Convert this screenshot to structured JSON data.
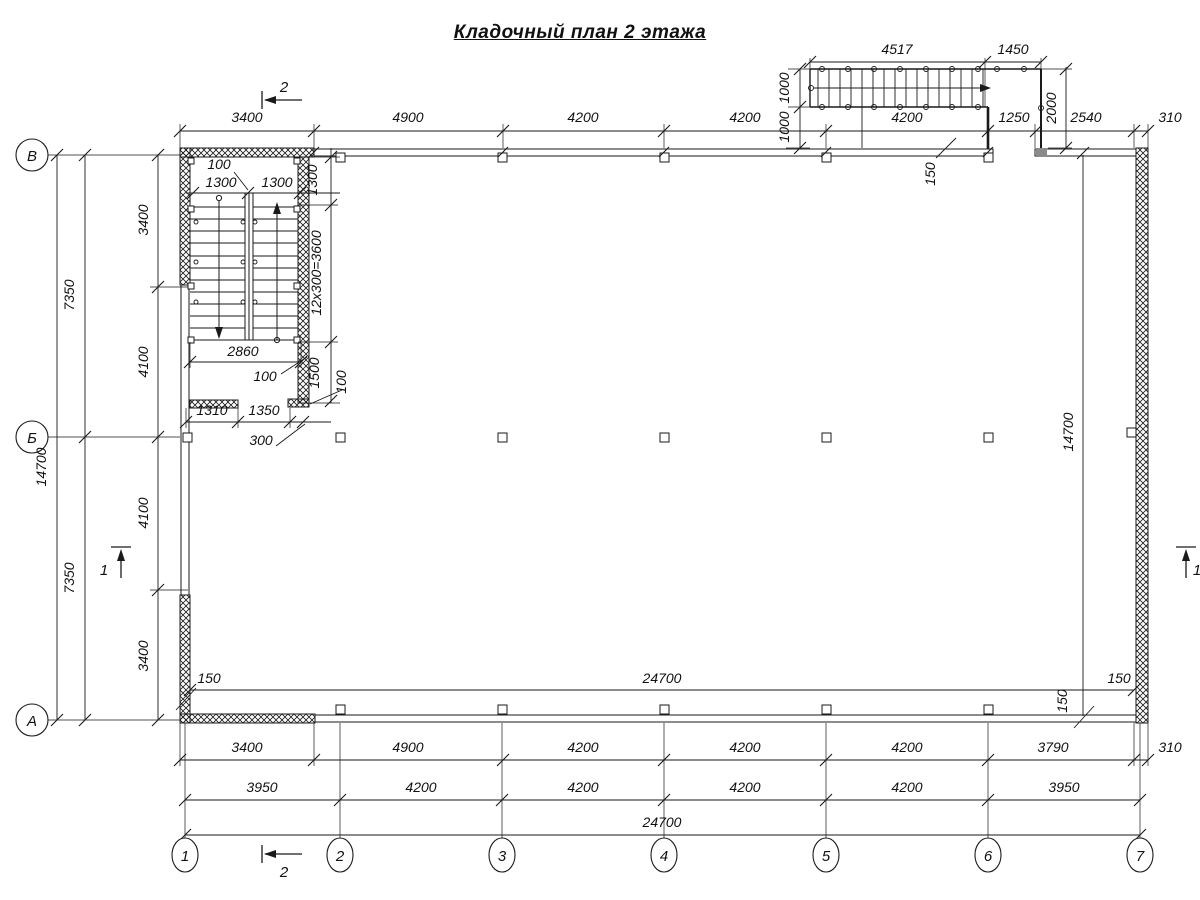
{
  "title": "Кладочный план 2 этажа",
  "colors": {
    "ink": "#1a1a1a",
    "paper": "#ffffff"
  },
  "axes": {
    "columns": [
      "1",
      "2",
      "3",
      "4",
      "5",
      "6",
      "7"
    ],
    "rows": [
      "В",
      "Б",
      "А"
    ]
  },
  "section_marks": [
    "1",
    "2"
  ],
  "labels": [
    {
      "n": "dim-top-3400",
      "t": "3400",
      "x": 247,
      "y": 122
    },
    {
      "n": "dim-top-4900",
      "t": "4900",
      "x": 408,
      "y": 122
    },
    {
      "n": "dim-top-4200-a",
      "t": "4200",
      "x": 583,
      "y": 122
    },
    {
      "n": "dim-top-4200-b",
      "t": "4200",
      "x": 745,
      "y": 122
    },
    {
      "n": "dim-top-4200-c",
      "t": "4200",
      "x": 907,
      "y": 122
    },
    {
      "n": "dim-top-1250",
      "t": "1250",
      "x": 1014,
      "y": 122
    },
    {
      "n": "dim-top-2540",
      "t": "2540",
      "x": 1086,
      "y": 122
    },
    {
      "n": "dim-top-310",
      "t": "310",
      "x": 1170,
      "y": 122
    },
    {
      "n": "dim-extstair-4517",
      "t": "4517",
      "x": 897,
      "y": 54
    },
    {
      "n": "dim-extstair-1450",
      "t": "1450",
      "x": 1013,
      "y": 54
    },
    {
      "n": "dim-extstair-1000-a",
      "t": "1000",
      "x": 789,
      "y": 88,
      "r": -90
    },
    {
      "n": "dim-extstair-1000-b",
      "t": "1000",
      "x": 789,
      "y": 127,
      "r": -90
    },
    {
      "n": "dim-extstair-2000",
      "t": "2000",
      "x": 1056,
      "y": 108,
      "r": -90
    },
    {
      "n": "dim-wall-150-top",
      "t": "150",
      "x": 935,
      "y": 174,
      "r": -90
    },
    {
      "n": "dim-stairwell-100-top",
      "t": "100",
      "x": 219,
      "y": 169
    },
    {
      "n": "dim-stairwell-1300-a",
      "t": "1300",
      "x": 221,
      "y": 187
    },
    {
      "n": "dim-stairwell-1300-b",
      "t": "1300",
      "x": 277,
      "y": 187
    },
    {
      "n": "dim-stairwell-1300-v",
      "t": "1300",
      "x": 317,
      "y": 180,
      "r": -90
    },
    {
      "n": "dim-stairwell-12x300",
      "t": "12x300=3600",
      "x": 321,
      "y": 273,
      "r": -90
    },
    {
      "n": "dim-stairwell-2860",
      "t": "2860",
      "x": 243,
      "y": 356
    },
    {
      "n": "dim-stairwell-100-mid",
      "t": "100",
      "x": 265,
      "y": 381
    },
    {
      "n": "dim-stairwell-1500",
      "t": "1500",
      "x": 319,
      "y": 373,
      "r": -90
    },
    {
      "n": "dim-stairwell-100-v",
      "t": "100",
      "x": 346,
      "y": 382,
      "r": -90
    },
    {
      "n": "dim-stairwell-1310",
      "t": "1310",
      "x": 212,
      "y": 415
    },
    {
      "n": "dim-stairwell-1350",
      "t": "1350",
      "x": 264,
      "y": 415
    },
    {
      "n": "dim-stairwell-300",
      "t": "300",
      "x": 261,
      "y": 445
    },
    {
      "n": "dim-left-14700",
      "t": "14700",
      "x": 46,
      "y": 467,
      "r": -90
    },
    {
      "n": "dim-left-7350-a",
      "t": "7350",
      "x": 74,
      "y": 295,
      "r": -90
    },
    {
      "n": "dim-left-7350-b",
      "t": "7350",
      "x": 74,
      "y": 578,
      "r": -90
    },
    {
      "n": "dim-left-3400-a",
      "t": "3400",
      "x": 148,
      "y": 220,
      "r": -90
    },
    {
      "n": "dim-left-4100-a",
      "t": "4100",
      "x": 148,
      "y": 362,
      "r": -90
    },
    {
      "n": "dim-left-4100-b",
      "t": "4100",
      "x": 148,
      "y": 513,
      "r": -90
    },
    {
      "n": "dim-left-3400-b",
      "t": "3400",
      "x": 148,
      "y": 656,
      "r": -90
    },
    {
      "n": "dim-inner-150-left",
      "t": "150",
      "x": 209,
      "y": 683
    },
    {
      "n": "dim-inner-24700",
      "t": "24700",
      "x": 662,
      "y": 683
    },
    {
      "n": "dim-inner-150-right",
      "t": "150",
      "x": 1119,
      "y": 683
    },
    {
      "n": "dim-inner-150-v",
      "t": "150",
      "x": 1067,
      "y": 701,
      "r": -90
    },
    {
      "n": "dim-right-14700",
      "t": "14700",
      "x": 1073,
      "y": 432,
      "r": -90
    },
    {
      "n": "dim-bot1-3400",
      "t": "3400",
      "x": 247,
      "y": 752
    },
    {
      "n": "dim-bot1-4900",
      "t": "4900",
      "x": 408,
      "y": 752
    },
    {
      "n": "dim-bot1-4200-a",
      "t": "4200",
      "x": 583,
      "y": 752
    },
    {
      "n": "dim-bot1-4200-b",
      "t": "4200",
      "x": 745,
      "y": 752
    },
    {
      "n": "dim-bot1-4200-c",
      "t": "4200",
      "x": 907,
      "y": 752
    },
    {
      "n": "dim-bot1-3790",
      "t": "3790",
      "x": 1053,
      "y": 752
    },
    {
      "n": "dim-bot1-310",
      "t": "310",
      "x": 1170,
      "y": 752
    },
    {
      "n": "dim-bot2-3950-a",
      "t": "3950",
      "x": 262,
      "y": 792
    },
    {
      "n": "dim-bot2-4200-a",
      "t": "4200",
      "x": 421,
      "y": 792
    },
    {
      "n": "dim-bot2-4200-b",
      "t": "4200",
      "x": 583,
      "y": 792
    },
    {
      "n": "dim-bot2-4200-c",
      "t": "4200",
      "x": 745,
      "y": 792
    },
    {
      "n": "dim-bot2-4200-d",
      "t": "4200",
      "x": 907,
      "y": 792
    },
    {
      "n": "dim-bot2-3950-b",
      "t": "3950",
      "x": 1064,
      "y": 792
    },
    {
      "n": "dim-bot3-24700",
      "t": "24700",
      "x": 662,
      "y": 827
    },
    {
      "n": "axis-col-1-label",
      "t": "1",
      "x": 185,
      "y": 861,
      "cls": "axis"
    },
    {
      "n": "axis-col-2-label",
      "t": "2",
      "x": 340,
      "y": 861,
      "cls": "axis"
    },
    {
      "n": "axis-col-3-label",
      "t": "3",
      "x": 502,
      "y": 861,
      "cls": "axis"
    },
    {
      "n": "axis-col-4-label",
      "t": "4",
      "x": 664,
      "y": 861,
      "cls": "axis"
    },
    {
      "n": "axis-col-5-label",
      "t": "5",
      "x": 826,
      "y": 861,
      "cls": "axis"
    },
    {
      "n": "axis-col-6-label",
      "t": "6",
      "x": 988,
      "y": 861,
      "cls": "axis"
    },
    {
      "n": "axis-col-7-label",
      "t": "7",
      "x": 1140,
      "y": 861,
      "cls": "axis"
    },
    {
      "n": "axis-row-v-label",
      "t": "В",
      "x": 32,
      "y": 161,
      "cls": "axis"
    },
    {
      "n": "axis-row-b-label",
      "t": "Б",
      "x": 32,
      "y": 443,
      "cls": "axis"
    },
    {
      "n": "axis-row-a-label",
      "t": "А",
      "x": 32,
      "y": 726,
      "cls": "axis"
    },
    {
      "n": "section-2-top-label",
      "t": "2",
      "x": 284,
      "y": 92,
      "cls": "axis"
    },
    {
      "n": "section-2-bottom-label",
      "t": "2",
      "x": 284,
      "y": 877,
      "cls": "axis"
    },
    {
      "n": "section-1-left-label",
      "t": "1",
      "x": 104,
      "y": 575,
      "cls": "axis"
    },
    {
      "n": "section-1-right-label",
      "t": "1",
      "x": 1197,
      "y": 575,
      "cls": "axis"
    }
  ]
}
